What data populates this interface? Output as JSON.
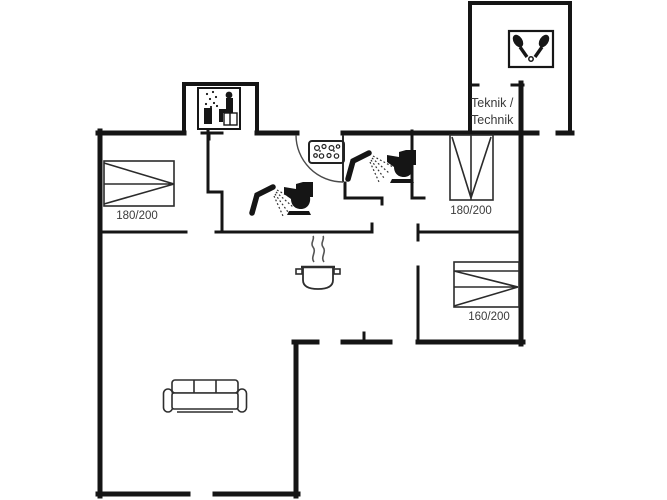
{
  "floorplan": {
    "labels": {
      "bed_top_left_size": "180/200",
      "bed_top_right_size": "180/200",
      "bed_bottom_right_size": "160/200",
      "technical_room_line1": "Teknik /",
      "technical_room_line2": "Technik"
    },
    "icons": [
      "sauna-icon",
      "table-tennis-icon",
      "dishwasher-icon",
      "entrance-door-arc",
      "shower-icon",
      "toilet-icon",
      "shower-icon",
      "toilet-icon",
      "cooking-pot-icon",
      "sofa",
      "double-bed",
      "double-bed",
      "double-bed"
    ],
    "colors": {
      "background": "#ffffff",
      "walls": "#151515",
      "furniture": "#2e2e2e",
      "text": "#3a3a3a"
    }
  }
}
